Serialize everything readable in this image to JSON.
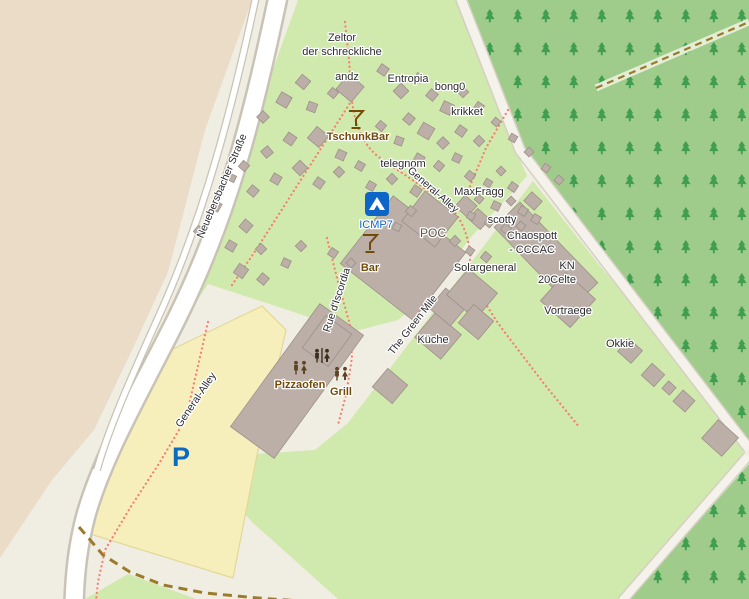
{
  "map": {
    "title": "Camp site map",
    "colors": {
      "base": "#f0ede3",
      "farmland": "#eadcc6",
      "grass": "#d0e9ac",
      "forest": "#9fcb8b",
      "tree": "#3f9e4f",
      "parking_fill": "#f6efbc",
      "parking_stroke": "#e3d894",
      "road_fill": "#ffffff",
      "road_casing": "#c9c3b6",
      "minor_road_fill": "#f4f2ea",
      "minor_road_casing": "#d5d0c3",
      "footpath": "#f87d6f",
      "track": "#9a7b2b",
      "forest_track_band": "#e4eed6",
      "building_fill": "#bcafa8",
      "building_stroke": "#9d9089",
      "label": "#2b2b2e",
      "poi_brown": "#734a08",
      "poi_blue": "#0d65c8",
      "building_label": "#5d564c"
    },
    "areas": [
      {
        "name": "farmland-area",
        "points": "0,0 252,0 205,130 168,272 133,348 94,430 52,480 0,558",
        "fill": "farmland"
      },
      {
        "name": "camp-grass-area",
        "points": "298,0 457,0 516,150 527,176 472,236 426,296 398,320 352,332 282,308 208,284 148,374 126,412 158,346 194,276 226,210 254,122",
        "fill": "grass"
      },
      {
        "name": "east-grass-area",
        "points": "533,181 600,266 662,340 742,446 744,456 686,524 622,599 338,599 252,522 196,458 315,450 348,423 394,363 440,303 486,243",
        "fill": "grass"
      },
      {
        "name": "south-grass-triangle",
        "points": "128,574 196,599 85,599",
        "fill": "grass"
      },
      {
        "name": "parking-area",
        "points": "167,352 262,306 286,330 270,400 258,450 233,578 87,533 103,468 127,416 150,373",
        "fill": "parking_fill",
        "stroke": "parking_stroke"
      }
    ],
    "forest_polys": [
      {
        "name": "forest-north-east",
        "points": "464,0 749,0 749,442 538,182 524,150"
      },
      {
        "name": "forest-south-east",
        "points": "630,599 749,464 749,599"
      }
    ],
    "lines": [
      {
        "name": "forest-track-band",
        "d": "M596,88 L749,22",
        "color": "forest_track_band",
        "w": 7
      },
      {
        "name": "forest-track-dashes",
        "d": "M596,88 L749,22",
        "color": "track",
        "w": 2.2,
        "dash": "7 5"
      },
      {
        "name": "camp-ring-road-casing",
        "d": "M459,-6 L520,150 L749,449",
        "color": "minor_road_casing",
        "w": 12
      },
      {
        "name": "camp-ring-road",
        "d": "M459,-6 L520,150 L749,449",
        "color": "minor_road_fill",
        "w": 9
      },
      {
        "name": "south-east-path-casing",
        "d": "M748,456 L622,601",
        "color": "minor_road_casing",
        "w": 11
      },
      {
        "name": "south-east-path",
        "d": "M748,456 L622,601",
        "color": "minor_road_fill",
        "w": 8
      },
      {
        "name": "main-road-casing",
        "d": "M279,-8 C252,120 228,215 176,320 C140,392 103,455 86,515 C78,545 75,572 74,604",
        "color": "road_casing",
        "w": 22
      },
      {
        "name": "main-road",
        "d": "M279,-8 C252,120 228,215 176,320 C140,392 103,455 86,515 C78,545 75,572 74,604",
        "color": "road_fill",
        "w": 17
      },
      {
        "name": "side-path-casing",
        "d": "M257,-8 C233,105 205,215 158,318 C130,380 108,430 97,470",
        "color": "road_casing",
        "w": 8
      },
      {
        "name": "side-path",
        "d": "M257,-8 C233,105 205,215 158,318 C130,380 108,430 97,470",
        "color": "road_fill",
        "w": 5.5
      },
      {
        "name": "track-south-west",
        "d": "M79,527 L103,555 L130,572 L163,585 L205,593 L258,598 L300,601",
        "color": "track",
        "w": 3,
        "dash": "9 6"
      },
      {
        "name": "footpath-general-alley-ne",
        "d": "M345,22 L349,60 L352,100 Q356,140 380,158 Q410,178 448,205 Q466,222 470,252 L470,270",
        "color": "footpath",
        "w": 2.2,
        "dash": "0.1 4.4",
        "cap": "round"
      },
      {
        "name": "footpath-to-solar",
        "d": "M470,270 Q481,300 503,330 L545,385 L580,428",
        "color": "footpath",
        "w": 2.2,
        "dash": "0.1 4.4",
        "cap": "round"
      },
      {
        "name": "footpath-sw-branch",
        "d": "M352,100 L320,150 L288,200 L256,250 L230,288",
        "color": "footpath",
        "w": 2.2,
        "dash": "0.1 4.4",
        "cap": "round"
      },
      {
        "name": "footpath-rue-discordia",
        "d": "M327,238 L338,282 L350,325 L352,358 L346,395 L338,425",
        "color": "footpath",
        "w": 2.2,
        "dash": "0.1 4.4",
        "cap": "round"
      },
      {
        "name": "footpath-krikket",
        "d": "M508,110 L486,148 L470,186 L468,216",
        "color": "footpath",
        "w": 2.2,
        "dash": "0.1 4.4",
        "cap": "round"
      },
      {
        "name": "footpath-parking",
        "d": "M208,322 L186,418 L160,462 L130,508 L105,550 L98,582 L96,601",
        "color": "footpath",
        "w": 2.2,
        "dash": "0.1 4.4",
        "cap": "round"
      }
    ],
    "buildings": [
      [
        403,
        258,
        92,
        86,
        38
      ],
      [
        430,
        219,
        42,
        38,
        38
      ],
      [
        546,
        255,
        112,
        36,
        46
      ],
      [
        466,
        206,
        16,
        15,
        42
      ],
      [
        479,
        219,
        16,
        14,
        42
      ],
      [
        533,
        201,
        14,
        12,
        42
      ],
      [
        568,
        300,
        40,
        38,
        42
      ],
      [
        438,
        336,
        34,
        32,
        40
      ],
      [
        448,
        307,
        28,
        26,
        40
      ],
      [
        472,
        294,
        38,
        34,
        40
      ],
      [
        476,
        322,
        26,
        24,
        40
      ],
      [
        390,
        386,
        26,
        24,
        40
      ],
      [
        630,
        351,
        18,
        17,
        42
      ],
      [
        653,
        375,
        17,
        16,
        42
      ],
      [
        669,
        388,
        10,
        10,
        42
      ],
      [
        684,
        401,
        16,
        15,
        42
      ],
      [
        720,
        438,
        27,
        25,
        42
      ],
      [
        297,
        381,
        152,
        54,
        -54
      ],
      [
        327,
        341,
        40,
        32,
        -54
      ]
    ],
    "tents": [
      [
        303,
        82,
        11,
        40
      ],
      [
        284,
        100,
        12,
        30
      ],
      [
        263,
        117,
        9,
        45
      ],
      [
        312,
        107,
        9,
        20
      ],
      [
        333,
        93,
        8,
        40
      ],
      [
        290,
        139,
        10,
        35
      ],
      [
        267,
        152,
        9,
        50
      ],
      [
        318,
        137,
        15,
        40
      ],
      [
        341,
        155,
        9,
        25
      ],
      [
        300,
        168,
        11,
        45
      ],
      [
        276,
        179,
        9,
        30
      ],
      [
        253,
        191,
        9,
        40
      ],
      [
        319,
        183,
        9,
        35
      ],
      [
        339,
        172,
        8,
        45
      ],
      [
        360,
        166,
        8,
        30
      ],
      [
        244,
        166,
        8,
        40
      ],
      [
        232,
        178,
        7,
        25
      ],
      [
        350,
        88,
        20,
        40
      ],
      [
        383,
        70,
        9,
        35
      ],
      [
        401,
        91,
        11,
        45
      ],
      [
        419,
        78,
        8,
        30
      ],
      [
        432,
        95,
        9,
        40
      ],
      [
        447,
        108,
        11,
        25
      ],
      [
        463,
        92,
        8,
        45
      ],
      [
        479,
        107,
        8,
        35
      ],
      [
        409,
        119,
        9,
        40
      ],
      [
        426,
        131,
        13,
        30
      ],
      [
        443,
        143,
        9,
        45
      ],
      [
        399,
        141,
        8,
        20
      ],
      [
        381,
        126,
        8,
        40
      ],
      [
        461,
        131,
        9,
        35
      ],
      [
        479,
        141,
        8,
        45
      ],
      [
        419,
        159,
        9,
        30
      ],
      [
        439,
        166,
        8,
        40
      ],
      [
        457,
        158,
        8,
        25
      ],
      [
        496,
        122,
        7,
        40
      ],
      [
        513,
        138,
        7,
        30
      ],
      [
        529,
        152,
        7,
        45
      ],
      [
        546,
        168,
        7,
        35
      ],
      [
        559,
        180,
        7,
        40
      ],
      [
        371,
        186,
        8,
        30
      ],
      [
        392,
        179,
        8,
        45
      ],
      [
        416,
        191,
        9,
        35
      ],
      [
        411,
        211,
        8,
        40
      ],
      [
        397,
        227,
        7,
        25
      ],
      [
        470,
        176,
        8,
        40
      ],
      [
        488,
        183,
        7,
        30
      ],
      [
        501,
        171,
        7,
        45
      ],
      [
        513,
        187,
        8,
        35
      ],
      [
        479,
        199,
        7,
        40
      ],
      [
        496,
        206,
        8,
        25
      ],
      [
        511,
        201,
        7,
        45
      ],
      [
        523,
        211,
        8,
        30
      ],
      [
        489,
        223,
        7,
        40
      ],
      [
        506,
        229,
        8,
        35
      ],
      [
        471,
        216,
        7,
        25
      ],
      [
        521,
        226,
        7,
        40
      ],
      [
        536,
        219,
        8,
        30
      ],
      [
        455,
        241,
        8,
        45
      ],
      [
        470,
        251,
        7,
        35
      ],
      [
        486,
        257,
        8,
        40
      ],
      [
        246,
        226,
        10,
        40
      ],
      [
        231,
        246,
        9,
        30
      ],
      [
        261,
        249,
        8,
        45
      ],
      [
        241,
        271,
        11,
        35
      ],
      [
        263,
        279,
        9,
        40
      ],
      [
        286,
        263,
        8,
        25
      ],
      [
        301,
        246,
        8,
        45
      ],
      [
        216,
        206,
        9,
        30
      ],
      [
        199,
        231,
        8,
        40
      ],
      [
        333,
        253,
        8,
        35
      ],
      [
        351,
        263,
        7,
        45
      ]
    ],
    "icons": [
      {
        "type": "martini",
        "name": "tschunkbar-cocktail-icon",
        "x": 356,
        "y": 120,
        "color": "poi_brown"
      },
      {
        "type": "martini",
        "name": "bar-cocktail-icon",
        "x": 370,
        "y": 244,
        "color": "poi_brown"
      },
      {
        "type": "campsite",
        "name": "icmp7-campsite-icon",
        "x": 377,
        "y": 204,
        "color": "poi_blue"
      },
      {
        "type": "toilets",
        "name": "toilets-icon",
        "x": 322,
        "y": 356,
        "color": "#3d2f1f"
      },
      {
        "type": "pair",
        "name": "pizzaofen-icon",
        "x": 300,
        "y": 368,
        "color": "#5d4426"
      },
      {
        "type": "pair",
        "name": "grill-icon",
        "x": 341,
        "y": 374,
        "color": "#5d4426"
      },
      {
        "type": "parking",
        "name": "parking-icon",
        "x": 181,
        "y": 457,
        "color": "#0a6cc0",
        "text": "P"
      }
    ],
    "labels": [
      {
        "name": "label-zeltor-1",
        "text": "Zeltor",
        "x": 342,
        "y": 38
      },
      {
        "name": "label-zeltor-2",
        "text": "der schreckliche",
        "x": 342,
        "y": 52
      },
      {
        "name": "label-andz",
        "text": "andz",
        "x": 347,
        "y": 77
      },
      {
        "name": "label-entropia",
        "text": "Entropia",
        "x": 408,
        "y": 79
      },
      {
        "name": "label-bong0",
        "text": "bong0",
        "x": 450,
        "y": 87
      },
      {
        "name": "label-krikket",
        "text": "krikket",
        "x": 467,
        "y": 112
      },
      {
        "name": "label-tschunkbar",
        "text": "TschunkBar",
        "x": 358,
        "y": 137,
        "color": "poi_brown",
        "bold": true
      },
      {
        "name": "label-telegnom",
        "text": "telegnom",
        "x": 403,
        "y": 164
      },
      {
        "name": "label-general-alley-ne",
        "text": "General-Alley",
        "x": 433,
        "y": 190,
        "rot": 41,
        "size": 10.5
      },
      {
        "name": "label-maxfragg",
        "text": "MaxFragg",
        "x": 479,
        "y": 192
      },
      {
        "name": "label-scotty",
        "text": "scotty",
        "x": 502,
        "y": 220
      },
      {
        "name": "label-chaospott",
        "text": "Chaospott",
        "x": 532,
        "y": 236
      },
      {
        "name": "label-cccac",
        "text": "- CCCAC",
        "x": 532,
        "y": 250
      },
      {
        "name": "label-kn",
        "text": "KN",
        "x": 567,
        "y": 266
      },
      {
        "name": "label-20celte",
        "text": "20Celte",
        "x": 557,
        "y": 280
      },
      {
        "name": "label-solargeneral",
        "text": "Solargeneral",
        "x": 485,
        "y": 268
      },
      {
        "name": "label-vortraege",
        "text": "Vortraege",
        "x": 568,
        "y": 311
      },
      {
        "name": "label-kueche",
        "text": "Küche",
        "x": 433,
        "y": 340
      },
      {
        "name": "label-okkie",
        "text": "Okkie",
        "x": 620,
        "y": 344
      },
      {
        "name": "label-green-mile",
        "text": "The Green Mile",
        "x": 413,
        "y": 325,
        "rot": -52,
        "size": 10.5
      },
      {
        "name": "label-rue-discordia",
        "text": "Rue d'Iscordia",
        "x": 337,
        "y": 300,
        "rot": -72,
        "size": 10.5
      },
      {
        "name": "label-neuebersbacher",
        "text": "Neuebersbacher Straße",
        "x": 222,
        "y": 186,
        "rot": -67,
        "size": 10.5
      },
      {
        "name": "label-general-alley-sw",
        "text": "General-Alley",
        "x": 196,
        "y": 400,
        "rot": -56,
        "size": 10.5
      },
      {
        "name": "label-icmp7",
        "text": "ICMP7",
        "x": 376,
        "y": 225,
        "color": "poi_blue"
      },
      {
        "name": "label-poc",
        "text": "POC",
        "x": 433,
        "y": 233,
        "size": 12,
        "color": "building_label"
      },
      {
        "name": "label-bar",
        "text": "Bar",
        "x": 370,
        "y": 268,
        "color": "poi_brown",
        "bold": true
      },
      {
        "name": "label-pizzaofen",
        "text": "Pizzaofen",
        "x": 300,
        "y": 385,
        "color": "poi_brown",
        "bold": true
      },
      {
        "name": "label-grill",
        "text": "Grill",
        "x": 341,
        "y": 392,
        "color": "poi_brown",
        "bold": true
      }
    ]
  }
}
